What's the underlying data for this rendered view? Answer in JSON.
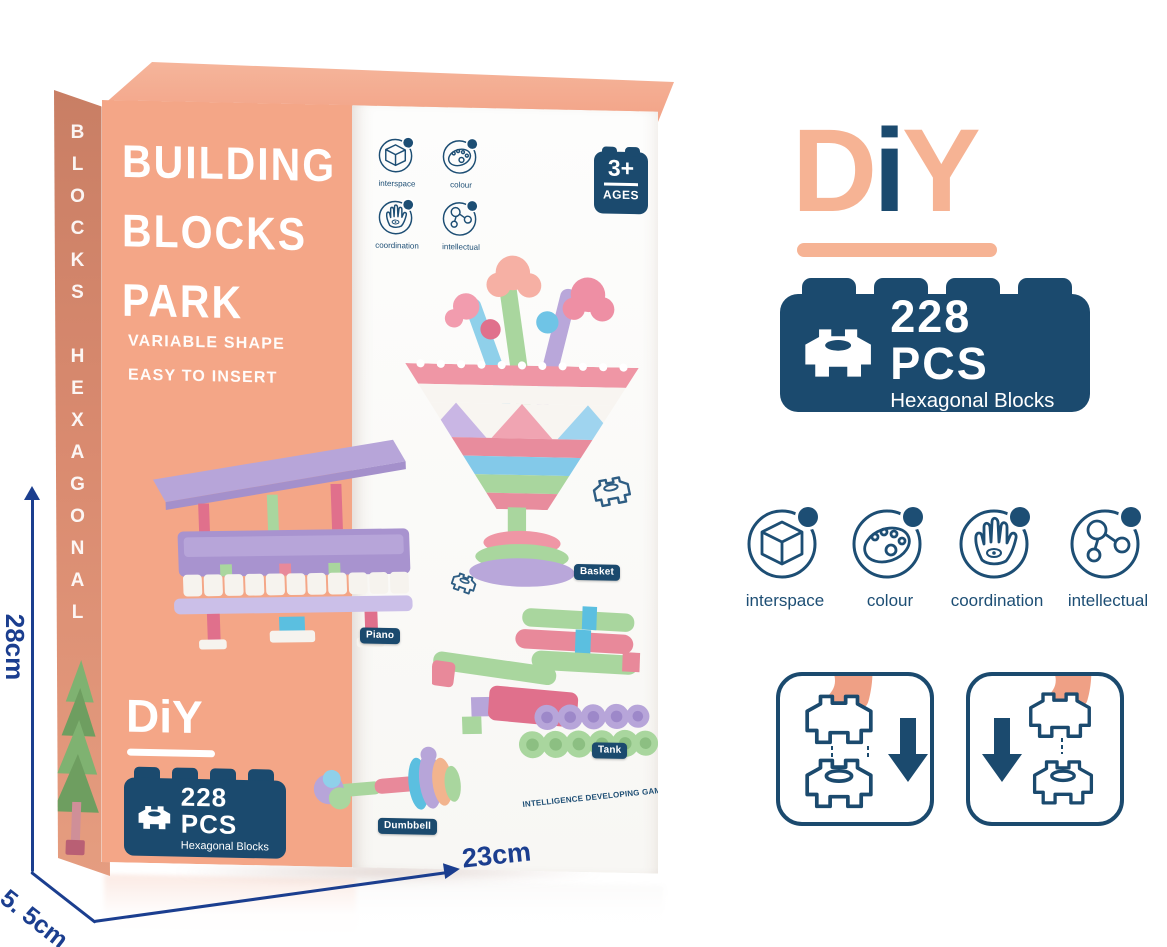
{
  "box": {
    "spine_text": "BLOCKS HEXAGONAL",
    "front": {
      "title1": "BUILDING",
      "title2": "BLOCKS",
      "title3": "PARK",
      "subtitle1": "VARIABLE SHAPE",
      "subtitle2": "EASY TO INSERT",
      "logo_text": "DiY",
      "pcs": {
        "count": "228 PCS",
        "label": "Hexagonal Blocks"
      },
      "age": {
        "value": "3+",
        "label": "AGES"
      },
      "toys": {
        "basket": "Basket",
        "piano": "Piano",
        "tank": "Tank",
        "dumbbell": "Dumbbell"
      },
      "tagline": "INTELLIGENCE DEVELOPING GAMES"
    }
  },
  "features": [
    {
      "label": "interspace",
      "icon": "cube-icon"
    },
    {
      "label": "colour",
      "icon": "palette-icon"
    },
    {
      "label": "coordination",
      "icon": "hand-eye-icon"
    },
    {
      "label": "intellectual",
      "icon": "molecule-icon"
    }
  ],
  "panel": {
    "logo": {
      "d": "D",
      "i": "i",
      "y": "Y"
    },
    "pcs": {
      "count": "228 PCS",
      "label": "Hexagonal Blocks"
    }
  },
  "dimensions": {
    "height": "28cm",
    "width": "23cm",
    "depth": "5. 5cm"
  },
  "colors": {
    "salmon": "#F4A687",
    "peach_logo": "#F6B394",
    "navy": "#1B4A6E",
    "dimension_blue": "#1B3E8F"
  }
}
